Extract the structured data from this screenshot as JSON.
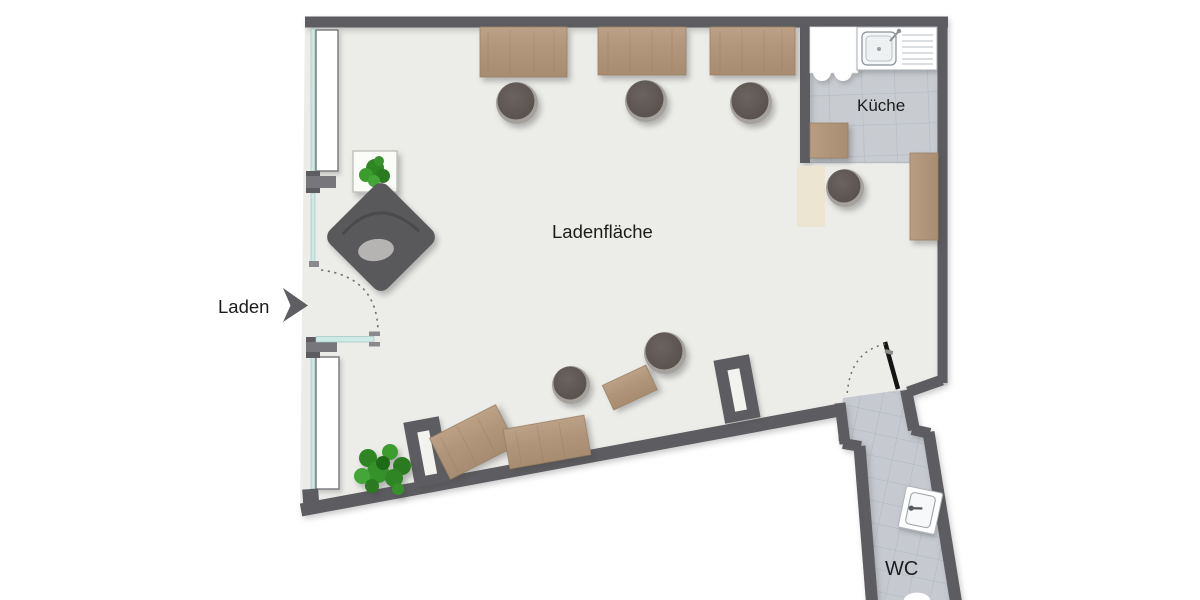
{
  "floorplan": {
    "labels": {
      "entrance": "Laden",
      "shop_floor": "Ladenfläche",
      "kitchen": "Küche",
      "wc": "WC"
    },
    "rooms": [
      "Ladenfläche",
      "Küche",
      "WC"
    ],
    "colors": {
      "wall": "#5d5c60",
      "shop_floor": "#ecede9",
      "kitchen_tile": "#c8ccd1",
      "wc_tile": "#c6cad0",
      "tile_grid": "#b2b9c0",
      "wood": "#b2977b",
      "glass": "#cfe9e5",
      "stool": "#5f5855",
      "plant": "#3f9b2f",
      "mat": "#ece5d1",
      "door_leaf": "#141414",
      "label_text": "#1c1c1c"
    },
    "furniture": {
      "tables": 6,
      "stools": 6,
      "plants": 2,
      "armchairs": 1,
      "sinks": 2,
      "sideboards": 2
    }
  }
}
